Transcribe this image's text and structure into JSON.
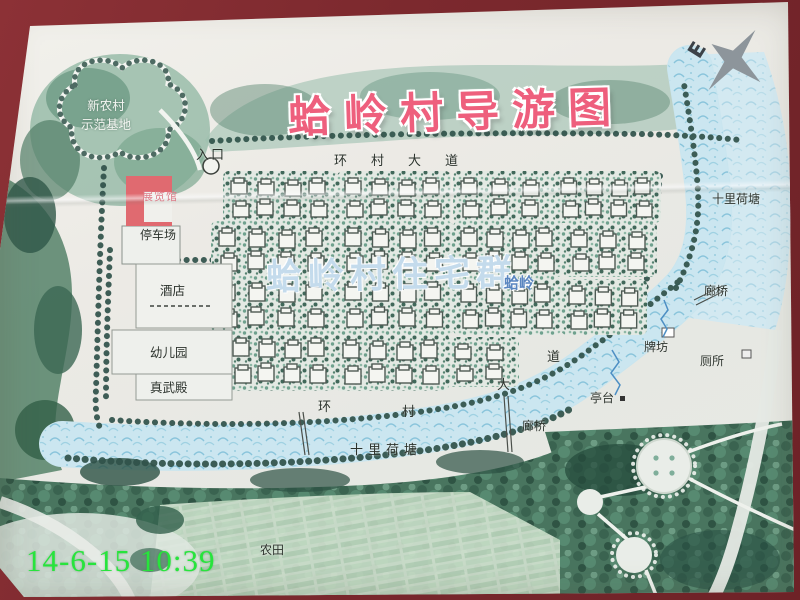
{
  "photo": {
    "timestamp": "14-6-15 10:39"
  },
  "map": {
    "title": "蛤岭村导游图",
    "compass_letter": "E",
    "labels": {
      "demo_base_line1": "新农村",
      "demo_base_line2": "示范基地",
      "entrance": "入口",
      "ring_road_top": "环村大道",
      "exhibition_hall": "展览馆",
      "parking": "停车场",
      "hotel": "酒店",
      "kindergarten": "幼儿园",
      "zhenwu_hall": "真武殿",
      "residential_overlay": "蛤岭村住宅群",
      "village_name": "蛤岭",
      "lotus_pond_right": "十里荷塘",
      "corridor_bridge_right": "廊桥",
      "archway": "牌坊",
      "toilet": "厕所",
      "pavilion": "亭台",
      "corridor_bridge_bottom": "廊桥",
      "lotus_pond_bottom": "十里荷塘",
      "farmland": "农田",
      "ring_road_curve_chars": [
        "环",
        "村",
        "大",
        "道"
      ]
    },
    "colors": {
      "title_pink": "#ee5f7d",
      "timestamp_green": "#27e43c",
      "residential_overlay_blue": "#b7d3e8",
      "frame_red": "#7c292e",
      "pond_blue": "#c9e5ef",
      "foliage_green": "#49755f",
      "board_background": "#e9eae5",
      "exhibition_building_red": "#e06a70"
    }
  }
}
